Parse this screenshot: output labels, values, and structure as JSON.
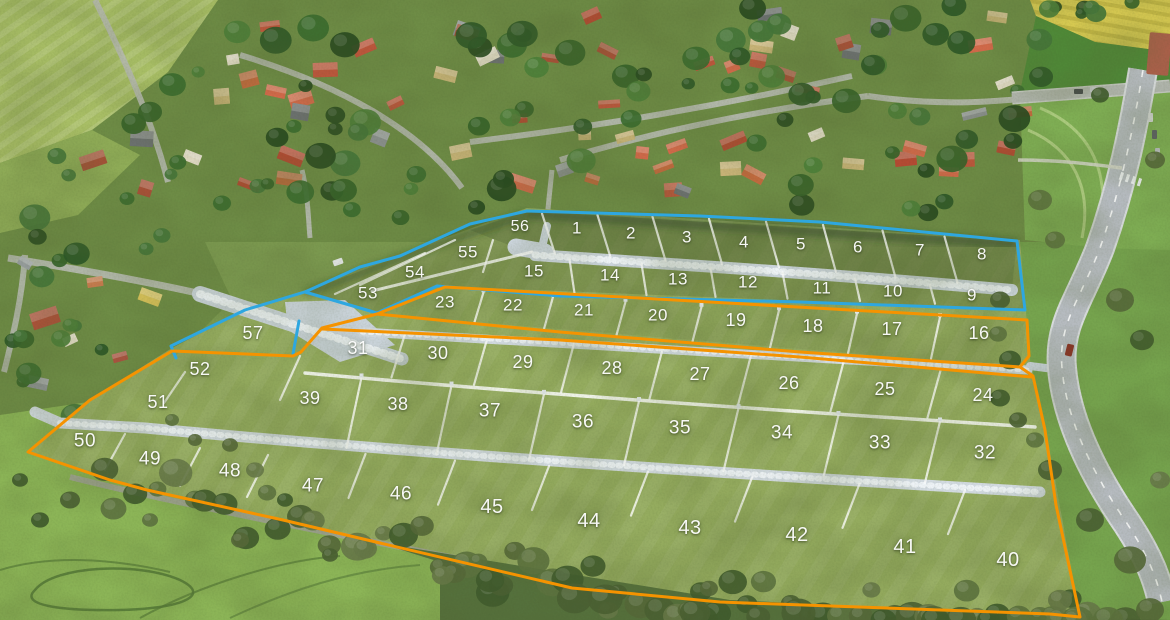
{
  "map": {
    "colors": {
      "blue_zone": "#2ea7e0",
      "orange_zone": "#f59300",
      "label": "#ffffff"
    },
    "plots": [
      {
        "n": "1",
        "x": 577,
        "y": 228,
        "zone": "blue"
      },
      {
        "n": "2",
        "x": 631,
        "y": 233,
        "zone": "blue"
      },
      {
        "n": "3",
        "x": 687,
        "y": 237,
        "zone": "blue"
      },
      {
        "n": "4",
        "x": 744,
        "y": 242,
        "zone": "blue"
      },
      {
        "n": "5",
        "x": 801,
        "y": 244,
        "zone": "blue"
      },
      {
        "n": "6",
        "x": 858,
        "y": 247,
        "zone": "blue"
      },
      {
        "n": "7",
        "x": 920,
        "y": 250,
        "zone": "blue"
      },
      {
        "n": "8",
        "x": 982,
        "y": 254,
        "zone": "blue"
      },
      {
        "n": "9",
        "x": 972,
        "y": 295,
        "zone": "blue"
      },
      {
        "n": "10",
        "x": 893,
        "y": 291,
        "zone": "blue"
      },
      {
        "n": "11",
        "x": 822,
        "y": 288,
        "zone": "blue"
      },
      {
        "n": "12",
        "x": 748,
        "y": 282,
        "zone": "blue"
      },
      {
        "n": "13",
        "x": 678,
        "y": 279,
        "zone": "blue"
      },
      {
        "n": "14",
        "x": 610,
        "y": 275,
        "zone": "blue"
      },
      {
        "n": "15",
        "x": 534,
        "y": 271,
        "zone": "blue"
      },
      {
        "n": "16",
        "x": 979,
        "y": 333,
        "zone": "orange"
      },
      {
        "n": "17",
        "x": 892,
        "y": 329,
        "zone": "orange"
      },
      {
        "n": "18",
        "x": 813,
        "y": 326,
        "zone": "orange"
      },
      {
        "n": "19",
        "x": 736,
        "y": 320,
        "zone": "orange"
      },
      {
        "n": "20",
        "x": 658,
        "y": 315,
        "zone": "orange"
      },
      {
        "n": "21",
        "x": 584,
        "y": 310,
        "zone": "orange"
      },
      {
        "n": "22",
        "x": 513,
        "y": 305,
        "zone": "orange"
      },
      {
        "n": "23",
        "x": 445,
        "y": 302,
        "zone": "orange"
      },
      {
        "n": "24",
        "x": 983,
        "y": 395,
        "zone": "orange"
      },
      {
        "n": "25",
        "x": 885,
        "y": 389,
        "zone": "orange"
      },
      {
        "n": "26",
        "x": 789,
        "y": 383,
        "zone": "orange"
      },
      {
        "n": "27",
        "x": 700,
        "y": 374,
        "zone": "orange"
      },
      {
        "n": "28",
        "x": 612,
        "y": 368,
        "zone": "orange"
      },
      {
        "n": "29",
        "x": 523,
        "y": 362,
        "zone": "orange"
      },
      {
        "n": "30",
        "x": 438,
        "y": 353,
        "zone": "orange"
      },
      {
        "n": "31",
        "x": 358,
        "y": 348,
        "zone": "orange"
      },
      {
        "n": "32",
        "x": 985,
        "y": 453,
        "zone": "orange"
      },
      {
        "n": "33",
        "x": 880,
        "y": 443,
        "zone": "orange"
      },
      {
        "n": "34",
        "x": 782,
        "y": 433,
        "zone": "orange"
      },
      {
        "n": "35",
        "x": 680,
        "y": 428,
        "zone": "orange"
      },
      {
        "n": "36",
        "x": 583,
        "y": 422,
        "zone": "orange"
      },
      {
        "n": "37",
        "x": 490,
        "y": 411,
        "zone": "orange"
      },
      {
        "n": "38",
        "x": 398,
        "y": 404,
        "zone": "orange"
      },
      {
        "n": "39",
        "x": 310,
        "y": 398,
        "zone": "orange"
      },
      {
        "n": "40",
        "x": 1008,
        "y": 560,
        "zone": "orange"
      },
      {
        "n": "41",
        "x": 905,
        "y": 547,
        "zone": "orange"
      },
      {
        "n": "42",
        "x": 797,
        "y": 535,
        "zone": "orange"
      },
      {
        "n": "43",
        "x": 690,
        "y": 528,
        "zone": "orange"
      },
      {
        "n": "44",
        "x": 589,
        "y": 521,
        "zone": "orange"
      },
      {
        "n": "45",
        "x": 492,
        "y": 507,
        "zone": "orange"
      },
      {
        "n": "46",
        "x": 401,
        "y": 494,
        "zone": "orange"
      },
      {
        "n": "47",
        "x": 313,
        "y": 486,
        "zone": "orange"
      },
      {
        "n": "48",
        "x": 230,
        "y": 471,
        "zone": "orange"
      },
      {
        "n": "49",
        "x": 150,
        "y": 459,
        "zone": "orange"
      },
      {
        "n": "50",
        "x": 85,
        "y": 441,
        "zone": "orange"
      },
      {
        "n": "51",
        "x": 158,
        "y": 402,
        "zone": "orange"
      },
      {
        "n": "52",
        "x": 200,
        "y": 369,
        "zone": "orange"
      },
      {
        "n": "53",
        "x": 368,
        "y": 293,
        "zone": "blue"
      },
      {
        "n": "54",
        "x": 415,
        "y": 272,
        "zone": "blue"
      },
      {
        "n": "55",
        "x": 468,
        "y": 252,
        "zone": "blue"
      },
      {
        "n": "56",
        "x": 520,
        "y": 227,
        "zone": "blue"
      },
      {
        "n": "57",
        "x": 253,
        "y": 333,
        "zone": "blue"
      }
    ],
    "outlines": [
      {
        "name": "zone-outline-blue-main",
        "color": "#2ea7e0",
        "width": 3,
        "closed": true,
        "points": "527,211 700,216 820,222 1017,241 1025,310 800,302 560,296 437,286 377,313 305,292 360,267 400,256 470,224"
      },
      {
        "name": "zone-outline-blue-plot57",
        "color": "#2ea7e0",
        "width": 3,
        "closed": false,
        "points": "308,291 245,310 171,346 176,358"
      },
      {
        "name": "zone-outline-blue-plot57-right",
        "color": "#2ea7e0",
        "width": 3,
        "closed": false,
        "points": "299,321 293,354"
      },
      {
        "name": "zone-outline-orange-main",
        "color": "#f59300",
        "width": 3,
        "closed": true,
        "points": "445,287 1027,320 1029,356 1020,367 1033,376 1045,430 1056,505 1080,617 1050,614 720,602 572,588 380,543 283,520 147,490 110,480 28,452 90,400 172,351 293,356 301,352 322,328 377,314"
      },
      {
        "name": "zone-outline-orange-strip-bottom",
        "color": "#f59300",
        "width": 3,
        "closed": false,
        "points": "377,314 560,332 800,352 1020,367"
      },
      {
        "name": "zone-outline-orange-lower-top",
        "color": "#f59300",
        "width": 3,
        "closed": false,
        "points": "322,329 560,340 800,357 1032,377"
      }
    ]
  }
}
